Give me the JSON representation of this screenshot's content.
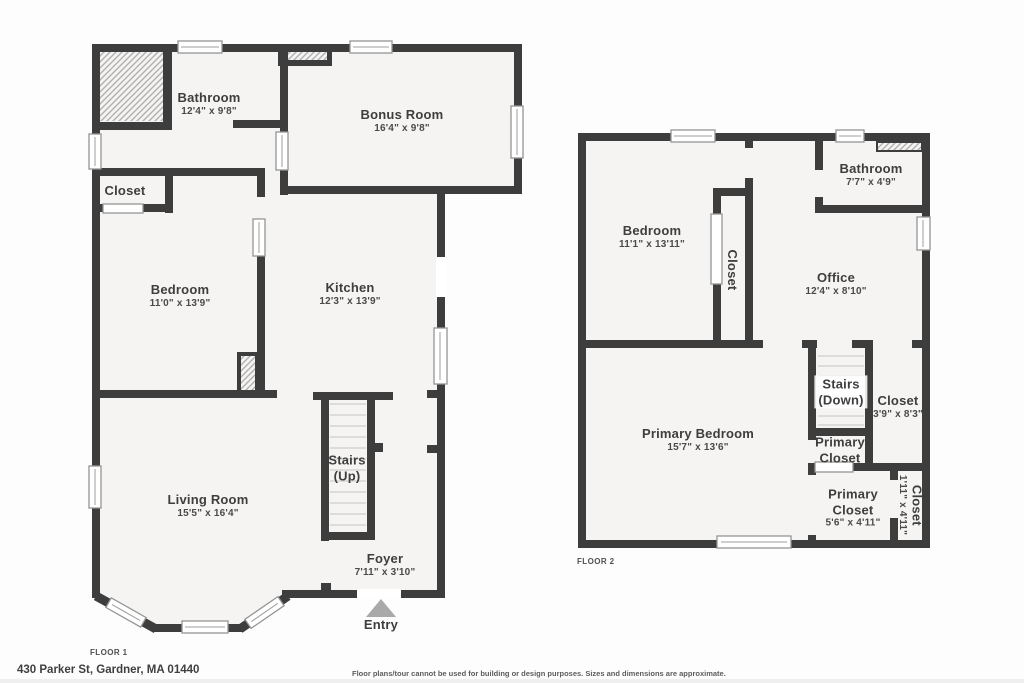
{
  "title": "Floor plan - 430 Parker St",
  "colors": {
    "wall": "#3d3d3d",
    "room_fill": "#f5f4f2",
    "hatch_line": "#b0b0b0",
    "entry_arrow": "#a9a9a9",
    "text": "#3e3e3e"
  },
  "floor1": {
    "label": "FLOOR 1",
    "entry": {
      "label": "Entry"
    },
    "rooms": [
      {
        "id": "bathroom",
        "name": "Bathroom",
        "dims": "12'4\" x 9'8\"",
        "x": 209,
        "y": 104
      },
      {
        "id": "bonus-room",
        "name": "Bonus Room",
        "dims": "16'4\" x 9'8\"",
        "x": 402,
        "y": 121
      },
      {
        "id": "closet",
        "name": "Closet",
        "x": 125,
        "y": 191
      },
      {
        "id": "bedroom",
        "name": "Bedroom",
        "dims": "11'0\" x 13'9\"",
        "x": 180,
        "y": 296
      },
      {
        "id": "kitchen",
        "name": "Kitchen",
        "dims": "12'3\" x 13'9\"",
        "x": 350,
        "y": 294
      },
      {
        "id": "living-room",
        "name": "Living Room",
        "dims": "15'5\" x 16'4\"",
        "x": 208,
        "y": 506
      },
      {
        "id": "stairs-up",
        "name": "Stairs",
        "name2": "(Up)",
        "x": 347,
        "y": 468
      },
      {
        "id": "foyer",
        "name": "Foyer",
        "dims": "7'11\" x 3'10\"",
        "x": 385,
        "y": 565
      },
      {
        "id": "entry",
        "name": "Entry",
        "x": 381,
        "y": 625
      }
    ]
  },
  "floor2": {
    "label": "FLOOR 2",
    "rooms": [
      {
        "id": "bedroom-2",
        "name": "Bedroom",
        "dims": "11'1\" x 13'11\"",
        "x": 652,
        "y": 237
      },
      {
        "id": "closet-hall",
        "name": "Closet",
        "x": 732,
        "y": 270,
        "vertical": true
      },
      {
        "id": "bathroom-2",
        "name": "Bathroom",
        "dims": "7'7\" x 4'9\"",
        "x": 871,
        "y": 175
      },
      {
        "id": "office",
        "name": "Office",
        "dims": "12'4\" x 8'10\"",
        "x": 836,
        "y": 284
      },
      {
        "id": "primary-bedroom",
        "name": "Primary Bedroom",
        "dims": "15'7\" x 13'6\"",
        "x": 698,
        "y": 440
      },
      {
        "id": "stairs-down",
        "name": "Stairs",
        "name2": "(Down)",
        "x": 841,
        "y": 392,
        "bg": true
      },
      {
        "id": "closet-right",
        "name": "Closet",
        "dims": "3'9\" x 8'3\"",
        "x": 898,
        "y": 407
      },
      {
        "id": "primary-closet-small",
        "name": "Primary",
        "name2": "Closet",
        "x": 840,
        "y": 450
      },
      {
        "id": "primary-closet",
        "name": "Primary",
        "name2": "Closet",
        "dims": "5'6\" x 4'11\"",
        "x": 853,
        "y": 508
      },
      {
        "id": "closet-bottom",
        "name": "Closet",
        "dims": "1'11\" x 4'11\"",
        "x": 910,
        "y": 505,
        "vertical": true
      }
    ]
  },
  "footer": {
    "address": "430 Parker St, Gardner, MA 01440",
    "disclaimer": "Floor plans/tour cannot be used for building or design purposes. Sizes and dimensions are approximate."
  }
}
